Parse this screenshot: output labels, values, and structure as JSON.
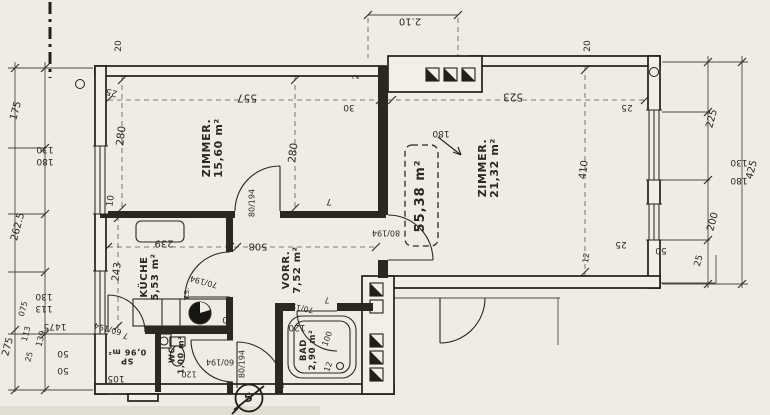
{
  "drawing": {
    "total_area": "55,38 m²",
    "section_marker": "5"
  },
  "colors": {
    "paper": "#f0ece4",
    "ink": "#2b2822",
    "dim": "#3a3730"
  },
  "rooms": [
    {
      "name": "ZIMMER.",
      "area": "15,60 m²"
    },
    {
      "name": "ZIMMER.",
      "area": "21,32 m²"
    },
    {
      "name": "KÜCHE",
      "area": "5,53 m²"
    },
    {
      "name": "VORR.",
      "area": "7,52 m²"
    },
    {
      "name": "BAD",
      "area": "2,90 m²"
    },
    {
      "name": "WC",
      "area": "1,00 m²"
    },
    {
      "name": "SP",
      "area": "0,96 m²"
    }
  ],
  "annotations": [
    {
      "text": "ZIMMER.\n15,60 m²",
      "x": 213,
      "y": 148,
      "r": -90,
      "fs": 11,
      "cls": "room",
      "name": "room-label-zimmer-1"
    },
    {
      "text": "ZIMMER.\n21,32 m²",
      "x": 489,
      "y": 168,
      "r": -90,
      "fs": 11,
      "cls": "room",
      "name": "room-label-zimmer-2"
    },
    {
      "text": "KÜCHE\n5,53 m²",
      "x": 151,
      "y": 277,
      "r": -90,
      "fs": 10,
      "cls": "room",
      "name": "room-label-kueche"
    },
    {
      "text": "VORR.\n7,52 m²",
      "x": 293,
      "y": 270,
      "r": -90,
      "fs": 10,
      "cls": "room",
      "name": "room-label-vorraum"
    },
    {
      "text": "BAD\n2,90 m²",
      "x": 309,
      "y": 350,
      "r": -90,
      "fs": 8.5,
      "cls": "room",
      "name": "room-label-bad"
    },
    {
      "text": "WC\n1,00 m²",
      "x": 177,
      "y": 355,
      "r": -90,
      "fs": 8,
      "cls": "room",
      "name": "room-label-wc"
    },
    {
      "text": "SP\n0,96 m²",
      "x": 127,
      "y": 356,
      "r": 180,
      "fs": 8,
      "cls": "room",
      "name": "room-label-sp"
    },
    {
      "text": "55,38 m²",
      "x": 421,
      "y": 196,
      "r": -90,
      "fs": 13,
      "cls": "total",
      "name": "area-total-label"
    },
    {
      "text": "5",
      "x": 249,
      "y": 398,
      "r": -15,
      "fs": 12,
      "cls": "total",
      "name": "section-number"
    },
    {
      "text": "2.10",
      "x": 410,
      "y": 20,
      "r": 180,
      "fs": 10,
      "name": "dim-210-top"
    },
    {
      "text": "20",
      "x": 120,
      "y": 46,
      "r": -90,
      "fs": 9,
      "name": "dim-20-left"
    },
    {
      "text": "20",
      "x": 589,
      "y": 46,
      "r": -90,
      "fs": 9,
      "name": "dim-20-right"
    },
    {
      "text": "2",
      "x": 357,
      "y": 77,
      "r": -90,
      "fs": 8,
      "name": "dim-2"
    },
    {
      "text": "30",
      "x": 349,
      "y": 106,
      "r": 180,
      "fs": 9,
      "name": "dim-30"
    },
    {
      "text": "557",
      "x": 247,
      "y": 97,
      "r": 180,
      "fs": 10.5,
      "name": "dim-557"
    },
    {
      "text": "523",
      "x": 513,
      "y": 96,
      "r": 180,
      "fs": 10.5,
      "name": "dim-523"
    },
    {
      "text": "25",
      "x": 112,
      "y": 91,
      "r": 195,
      "fs": 9,
      "name": "dim-25-topleft"
    },
    {
      "text": "25",
      "x": 627,
      "y": 106,
      "r": 180,
      "fs": 9,
      "name": "dim-25-topright"
    },
    {
      "text": "175",
      "x": 17,
      "y": 111,
      "r": -75,
      "fs": 10,
      "name": "dim-175"
    },
    {
      "text": "130",
      "x": 45,
      "y": 148,
      "r": 180,
      "fs": 9,
      "name": "dim-130-winleft"
    },
    {
      "text": "180",
      "x": 45,
      "y": 160,
      "r": 180,
      "fs": 9,
      "name": "dim-180-winleft"
    },
    {
      "text": "262.5",
      "x": 19,
      "y": 227,
      "r": -75,
      "fs": 10,
      "name": "dim-2625"
    },
    {
      "text": "130",
      "x": 44,
      "y": 295,
      "r": 180,
      "fs": 9,
      "name": "dim-130-winleft2"
    },
    {
      "text": "113",
      "x": 44,
      "y": 307,
      "r": 180,
      "fs": 9,
      "name": "dim-113-winleft2"
    },
    {
      "text": "275",
      "x": 9,
      "y": 347,
      "r": -75,
      "fs": 10,
      "name": "dim-275"
    },
    {
      "text": "075",
      "x": 24,
      "y": 309,
      "r": -75,
      "fs": 8,
      "name": "dim-075"
    },
    {
      "text": "113",
      "x": 27,
      "y": 334,
      "r": -75,
      "fs": 8,
      "name": "dim-113-bl"
    },
    {
      "text": "25",
      "x": 30,
      "y": 357,
      "r": -75,
      "fs": 8,
      "name": "dim-25-bl"
    },
    {
      "text": "139",
      "x": 42,
      "y": 339,
      "r": -75,
      "fs": 8.5,
      "name": "dim-139"
    },
    {
      "text": "1475",
      "x": 55,
      "y": 325,
      "r": 180,
      "fs": 9,
      "name": "dim-1475"
    },
    {
      "text": "50",
      "x": 63,
      "y": 352,
      "r": 180,
      "fs": 9,
      "name": "dim-50-a"
    },
    {
      "text": "50",
      "x": 63,
      "y": 369,
      "r": 180,
      "fs": 9,
      "name": "dim-50-b"
    },
    {
      "text": "105",
      "x": 116,
      "y": 377,
      "r": 180,
      "fs": 9,
      "name": "dim-105"
    },
    {
      "text": "280",
      "x": 122,
      "y": 136,
      "r": -83,
      "fs": 10.5,
      "name": "dim-280-left"
    },
    {
      "text": "280",
      "x": 294,
      "y": 153,
      "r": -83,
      "fs": 10.5,
      "name": "dim-280-right"
    },
    {
      "text": "10",
      "x": 112,
      "y": 201,
      "r": -83,
      "fs": 9,
      "name": "dim-10"
    },
    {
      "text": "7",
      "x": 329,
      "y": 200,
      "r": 180,
      "fs": 9,
      "name": "dim-7-z1"
    },
    {
      "text": "80/194",
      "x": 253,
      "y": 203,
      "r": -90,
      "fs": 8,
      "name": "door-size-zimmer1"
    },
    {
      "text": "243",
      "x": 118,
      "y": 272,
      "r": -83,
      "fs": 10,
      "name": "dim-243"
    },
    {
      "text": "239",
      "x": 164,
      "y": 242,
      "r": 180,
      "fs": 10,
      "name": "dim-239"
    },
    {
      "text": "508",
      "x": 258,
      "y": 245,
      "r": 180,
      "fs": 10,
      "name": "dim-508"
    },
    {
      "text": "70/194",
      "x": 204,
      "y": 281,
      "r": 195,
      "fs": 8,
      "name": "door-size-kueche"
    },
    {
      "text": "T.S.",
      "x": 188,
      "y": 294,
      "r": -90,
      "fs": 7,
      "name": "label-ts"
    },
    {
      "text": "60",
      "x": 228,
      "y": 318,
      "r": 180,
      "fs": 9,
      "name": "dim-60-counter"
    },
    {
      "text": "120",
      "x": 297,
      "y": 326,
      "r": 180,
      "fs": 9,
      "name": "dim-120-vorr"
    },
    {
      "text": "60/194",
      "x": 108,
      "y": 328,
      "r": 195,
      "fs": 8,
      "name": "door-size-sp"
    },
    {
      "text": "7",
      "x": 126,
      "y": 335,
      "r": 195,
      "fs": 8,
      "name": "dim-7-sp"
    },
    {
      "text": "60/194",
      "x": 220,
      "y": 361,
      "r": 180,
      "fs": 8,
      "name": "door-size-wc"
    },
    {
      "text": "120",
      "x": 189,
      "y": 373,
      "r": 180,
      "fs": 8,
      "name": "dim-120-wc"
    },
    {
      "text": "70/194",
      "x": 300,
      "y": 307,
      "r": 190,
      "fs": 8,
      "name": "door-size-bad"
    },
    {
      "text": "7",
      "x": 327,
      "y": 299,
      "r": 180,
      "fs": 8,
      "name": "dim-7-bad"
    },
    {
      "text": "100",
      "x": 328,
      "y": 339,
      "r": -70,
      "fs": 8,
      "name": "dim-100-bad"
    },
    {
      "text": "12",
      "x": 329,
      "y": 367,
      "r": -70,
      "fs": 8,
      "name": "dim-12-bad"
    },
    {
      "text": "80/194",
      "x": 243,
      "y": 364,
      "r": -90,
      "fs": 8,
      "name": "door-size-entry"
    },
    {
      "text": "80/194",
      "x": 386,
      "y": 232,
      "r": 180,
      "fs": 8,
      "name": "door-size-zimmer2"
    },
    {
      "text": "180",
      "x": 441,
      "y": 132,
      "r": 180,
      "fs": 9,
      "name": "dim-180-arrow"
    },
    {
      "text": "410",
      "x": 585,
      "y": 170,
      "r": -83,
      "fs": 10,
      "name": "dim-410"
    },
    {
      "text": "12",
      "x": 587,
      "y": 258,
      "r": -83,
      "fs": 8,
      "name": "dim-12-z2"
    },
    {
      "text": "25",
      "x": 621,
      "y": 243,
      "r": 180,
      "fs": 9,
      "name": "dim-25-z2"
    },
    {
      "text": "50",
      "x": 661,
      "y": 249,
      "r": 180,
      "fs": 9,
      "name": "dim-50-z2"
    },
    {
      "text": "25",
      "x": 700,
      "y": 261,
      "r": -75,
      "fs": 9,
      "name": "dim-25-br"
    },
    {
      "text": "225",
      "x": 713,
      "y": 119,
      "r": -75,
      "fs": 10,
      "name": "dim-225"
    },
    {
      "text": "130",
      "x": 739,
      "y": 161,
      "r": 180,
      "fs": 9,
      "name": "dim-130-winright"
    },
    {
      "text": "180",
      "x": 739,
      "y": 179,
      "r": 180,
      "fs": 9,
      "name": "dim-180-winright"
    },
    {
      "text": "200",
      "x": 714,
      "y": 222,
      "r": -75,
      "fs": 10,
      "name": "dim-200"
    },
    {
      "text": "425",
      "x": 753,
      "y": 170,
      "r": -75,
      "fs": 10,
      "name": "dim-425"
    }
  ]
}
